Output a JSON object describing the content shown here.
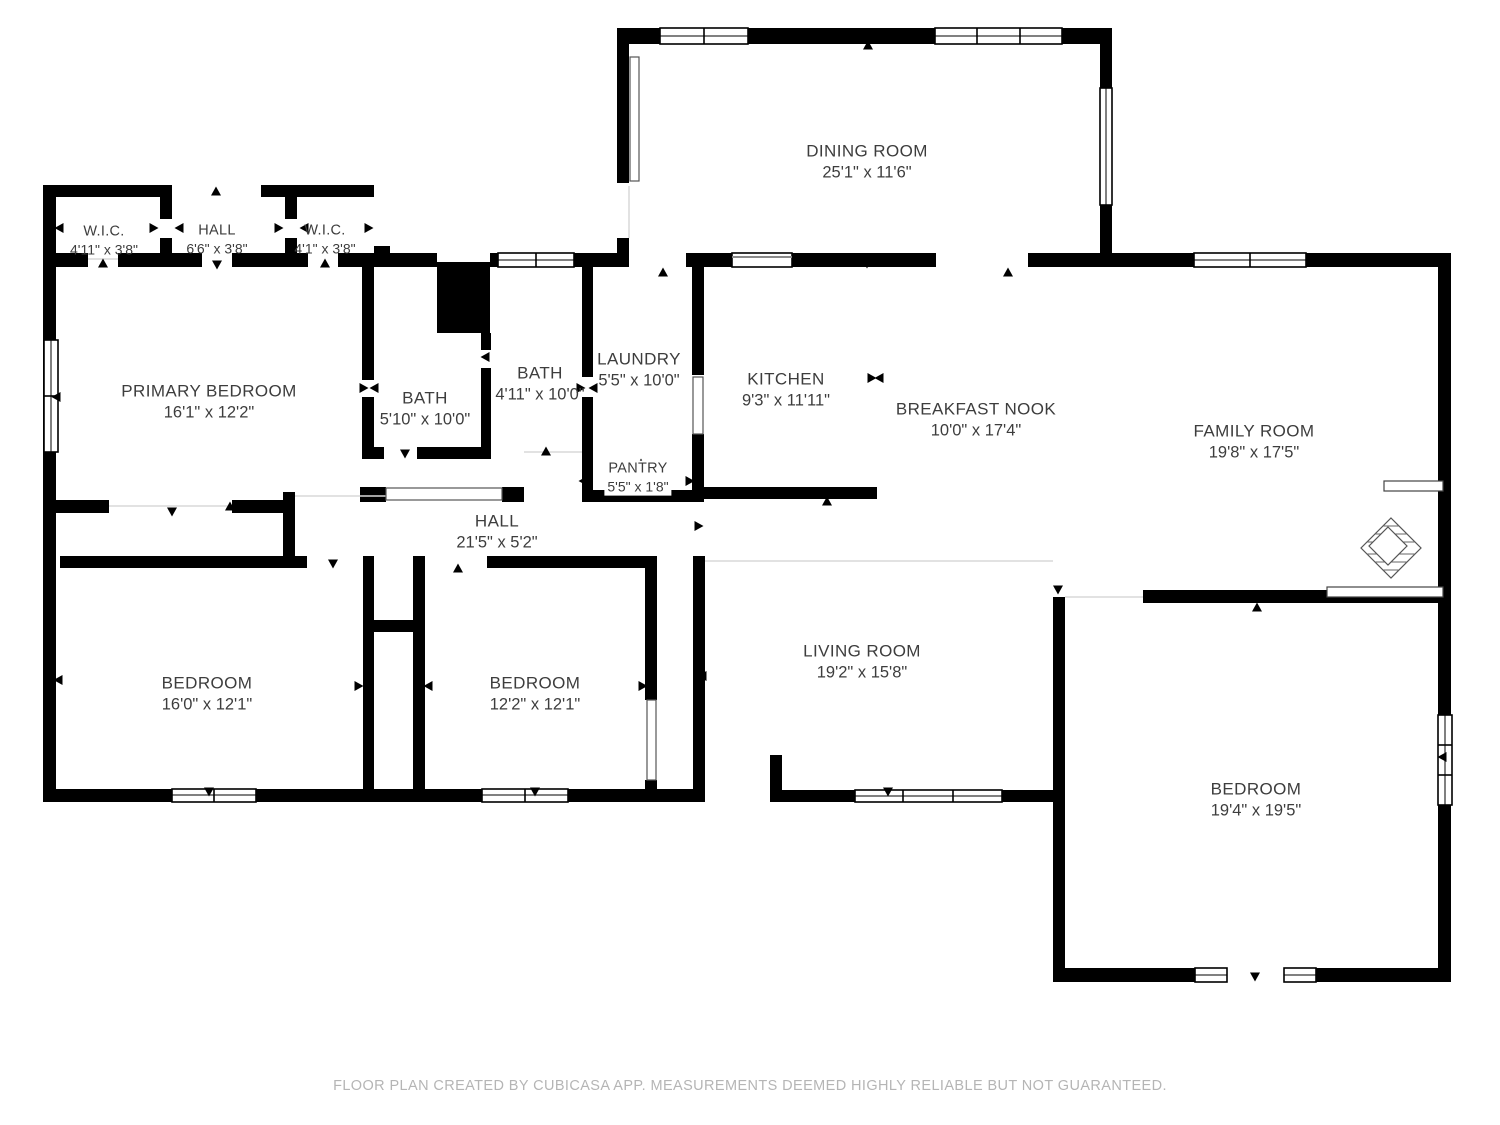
{
  "rooms": {
    "wic_left": {
      "name": "W.I.C.",
      "dims": "4'11\" x 3'8\""
    },
    "hall_top": {
      "name": "HALL",
      "dims": "6'6\" x 3'8\""
    },
    "wic_right": {
      "name": "W.I.C.",
      "dims": "4'1\" x 3'8\""
    },
    "dining": {
      "name": "DINING ROOM",
      "dims": "25'1\" x 11'6\""
    },
    "primary": {
      "name": "PRIMARY BEDROOM",
      "dims": "16'1\" x 12'2\""
    },
    "bath1": {
      "name": "BATH",
      "dims": "5'10\" x 10'0\""
    },
    "bath2": {
      "name": "BATH",
      "dims": "4'11\" x 10'0\""
    },
    "laundry": {
      "name": "LAUNDRY",
      "dims": "5'5\" x 10'0\""
    },
    "kitchen": {
      "name": "KITCHEN",
      "dims": "9'3\" x 11'11\""
    },
    "nook": {
      "name": "BREAKFAST NOOK",
      "dims": "10'0\" x 17'4\""
    },
    "family": {
      "name": "FAMILY ROOM",
      "dims": "19'8\" x 17'5\""
    },
    "pantry": {
      "name": "PANTRY",
      "dims": "5'5\" x 1'8\""
    },
    "hall_mid": {
      "name": "HALL",
      "dims": "21'5\" x 5'2\""
    },
    "bed1": {
      "name": "BEDROOM",
      "dims": "16'0\" x 12'1\""
    },
    "bed2": {
      "name": "BEDROOM",
      "dims": "12'2\" x 12'1\""
    },
    "living": {
      "name": "LIVING ROOM",
      "dims": "19'2\" x 15'8\""
    },
    "bed3": {
      "name": "BEDROOM",
      "dims": "19'4\" x 19'5\""
    }
  },
  "footer": {
    "text": "FLOOR PLAN CREATED BY CUBICASA APP. MEASUREMENTS DEEMED HIGHLY RELIABLE BUT NOT GUARANTEED."
  },
  "colors": {
    "wall": "#000000",
    "label_text": "#3d3d3d",
    "footer_text": "#b5b5b5"
  }
}
